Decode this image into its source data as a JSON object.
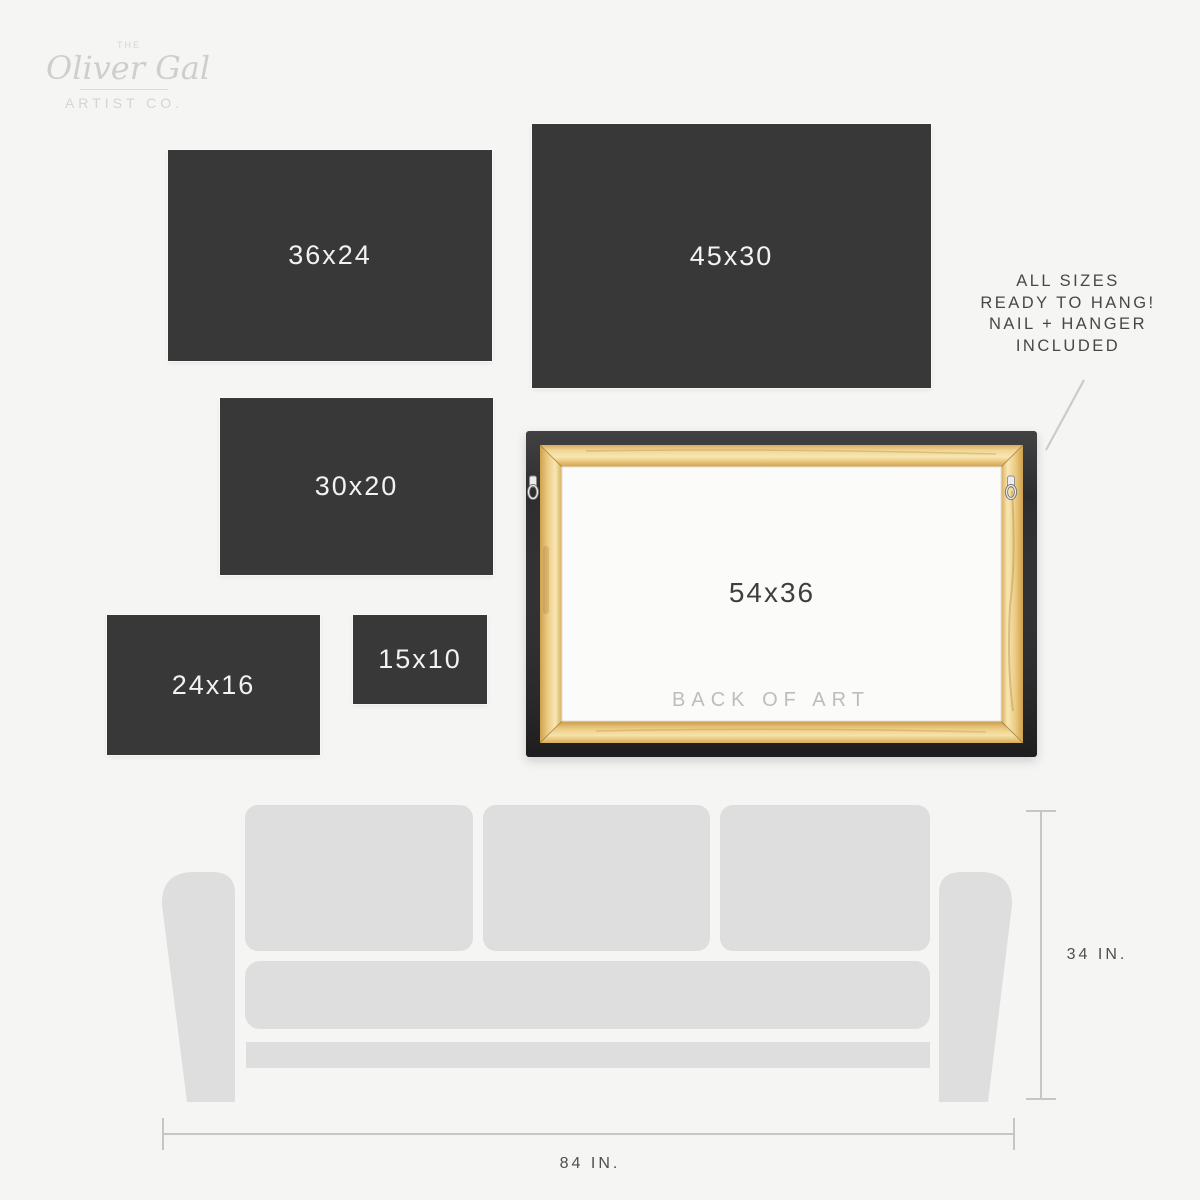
{
  "brand": {
    "prefix": "THE",
    "name": "Oliver Gal",
    "suffix": "ARTIST CO."
  },
  "size_boxes": [
    {
      "label": "36x24"
    },
    {
      "label": "45x30"
    },
    {
      "label": "30x20"
    },
    {
      "label": "24x16"
    },
    {
      "label": "15x10"
    }
  ],
  "back_of_art": {
    "size_label": "54x36",
    "caption": "BACK OF ART"
  },
  "note": {
    "line1": "ALL SIZES",
    "line2": "READY TO HANG!",
    "line3": "NAIL + HANGER",
    "line4": "INCLUDED"
  },
  "sofa_dimensions": {
    "height_label": "34 IN.",
    "width_label": "84 IN."
  },
  "colors": {
    "background": "#f5f5f4",
    "size_box": "#383839",
    "size_box_text": "#f2f2f2",
    "sofa_gray": "#dedede",
    "dimension_line": "#c6c6c6",
    "annotation_text": "#474747",
    "caption_gray": "#bdbdbd",
    "logo_gray": "#cfcfce",
    "frame_black": "#2d2d2f",
    "wood_light": "#f7e7b4",
    "wood_dark": "#cfa04e"
  }
}
